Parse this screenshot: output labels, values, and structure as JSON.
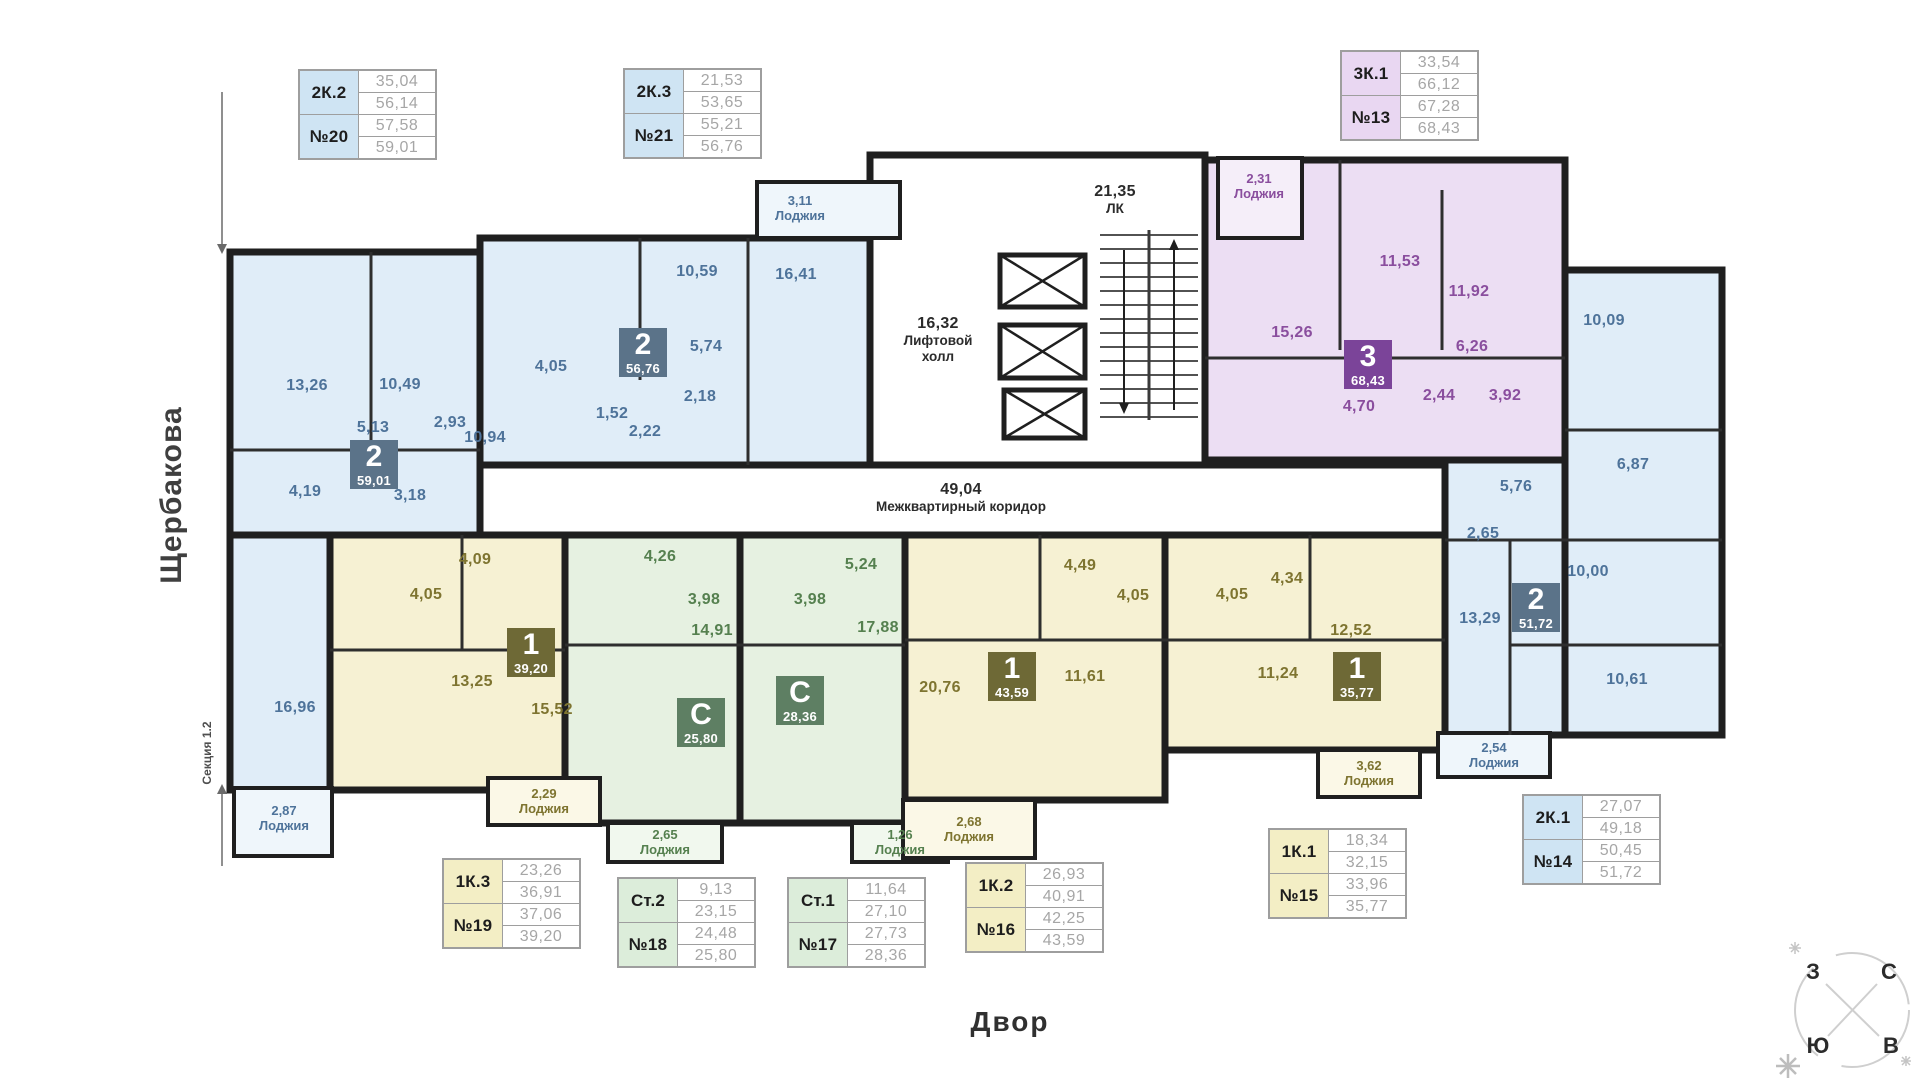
{
  "page": {
    "street": "Щербакова",
    "section": "Секция 1.2",
    "courtyard": "Двор"
  },
  "compass": {
    "west": "З",
    "north": "С",
    "south": "Ю",
    "east": "В"
  },
  "core": {
    "lift_area": "16,32",
    "lift_name": "Лифтовой холл",
    "stairs_area": "21,35",
    "stairs_name": "ЛК",
    "corridor_area": "49,04",
    "corridor_name": "Межквартирный коридор"
  },
  "apartments": {
    "apt20": {
      "badge_num": "2",
      "badge_area": "59,01",
      "rooms": [
        "13,26",
        "10,49",
        "5,13",
        "2,93",
        "4,19",
        "3,18",
        "16,96"
      ],
      "loggia_area": "2,87",
      "loggia_name": "Лоджия"
    },
    "apt21": {
      "badge_num": "2",
      "badge_area": "56,76",
      "rooms": [
        "10,94",
        "10,59",
        "16,41",
        "5,74",
        "4,05",
        "1,52",
        "2,18",
        "2,22"
      ],
      "loggia_area": "3,11",
      "loggia_name": "Лоджия"
    },
    "apt13": {
      "badge_num": "3",
      "badge_area": "68,43",
      "rooms": [
        "15,26",
        "11,53",
        "11,92",
        "6,26",
        "2,44",
        "3,92",
        "4,70"
      ],
      "loggia_area": "2,31",
      "loggia_name": "Лоджия"
    },
    "apt14": {
      "badge_num": "2",
      "badge_area": "51,72",
      "rooms": [
        "10,09",
        "6,87",
        "5,76",
        "2,65",
        "10,00",
        "13,29",
        "10,61"
      ],
      "loggia_area": "2,54",
      "loggia_name": "Лоджия"
    },
    "apt19": {
      "badge_num": "1",
      "badge_area": "39,20",
      "rooms": [
        "4,09",
        "4,05",
        "13,25",
        "15,52"
      ],
      "loggia_area": "2,29",
      "loggia_name": "Лоджия"
    },
    "apt18": {
      "badge_num": "С",
      "badge_area": "25,80",
      "rooms": [
        "4,26",
        "3,98",
        "14,91"
      ],
      "loggia_area": "2,65",
      "loggia_name": "Лоджия"
    },
    "apt17": {
      "badge_num": "С",
      "badge_area": "28,36",
      "rooms": [
        "3,98",
        "5,24",
        "17,88"
      ],
      "loggia_area": "1,26",
      "loggia_name": "Лоджия"
    },
    "apt16": {
      "badge_num": "1",
      "badge_area": "43,59",
      "rooms": [
        "4,49",
        "4,05",
        "20,76",
        "11,61"
      ],
      "loggia_area": "2,68",
      "loggia_name": "Лоджия"
    },
    "apt15": {
      "badge_num": "1",
      "badge_area": "35,77",
      "rooms": [
        "4,05",
        "4,34",
        "12,52",
        "11,24"
      ],
      "loggia_area": "3,62",
      "loggia_name": "Лоджия"
    }
  },
  "tables": {
    "t20": {
      "type": "2К.2",
      "num": "№20",
      "v": [
        "35,04",
        "56,14",
        "57,58",
        "59,01"
      ]
    },
    "t21": {
      "type": "2К.3",
      "num": "№21",
      "v": [
        "21,53",
        "53,65",
        "55,21",
        "56,76"
      ]
    },
    "t13": {
      "type": "3К.1",
      "num": "№13",
      "v": [
        "33,54",
        "66,12",
        "67,28",
        "68,43"
      ]
    },
    "t19": {
      "type": "1К.3",
      "num": "№19",
      "v": [
        "23,26",
        "36,91",
        "37,06",
        "39,20"
      ]
    },
    "t18": {
      "type": "Ст.2",
      "num": "№18",
      "v": [
        "9,13",
        "23,15",
        "24,48",
        "25,80"
      ]
    },
    "t17": {
      "type": "Ст.1",
      "num": "№17",
      "v": [
        "11,64",
        "27,10",
        "27,73",
        "28,36"
      ]
    },
    "t16": {
      "type": "1К.2",
      "num": "№16",
      "v": [
        "26,93",
        "40,91",
        "42,25",
        "43,59"
      ]
    },
    "t15": {
      "type": "1К.1",
      "num": "№15",
      "v": [
        "18,34",
        "32,15",
        "33,96",
        "35,77"
      ]
    },
    "t14": {
      "type": "2К.1",
      "num": "№14",
      "v": [
        "27,07",
        "49,18",
        "50,45",
        "51,72"
      ]
    }
  },
  "colors": {
    "wall": "#1f1f1f",
    "apt_blue": "#e0edf8",
    "apt_purple": "#ecdef3",
    "apt_yellow": "#f6f1d3",
    "apt_green": "#e6f1e1",
    "badge_blue": "#5b7389",
    "badge_purple": "#7b4499",
    "badge_olive": "#6e6936",
    "badge_green": "#5e7f63",
    "header_blue": "#cfe4f3",
    "header_purple": "#e9d7f2",
    "header_yellow": "#f3eec5",
    "header_green": "#dcedda",
    "table_value_text": "#a6a6a6"
  }
}
